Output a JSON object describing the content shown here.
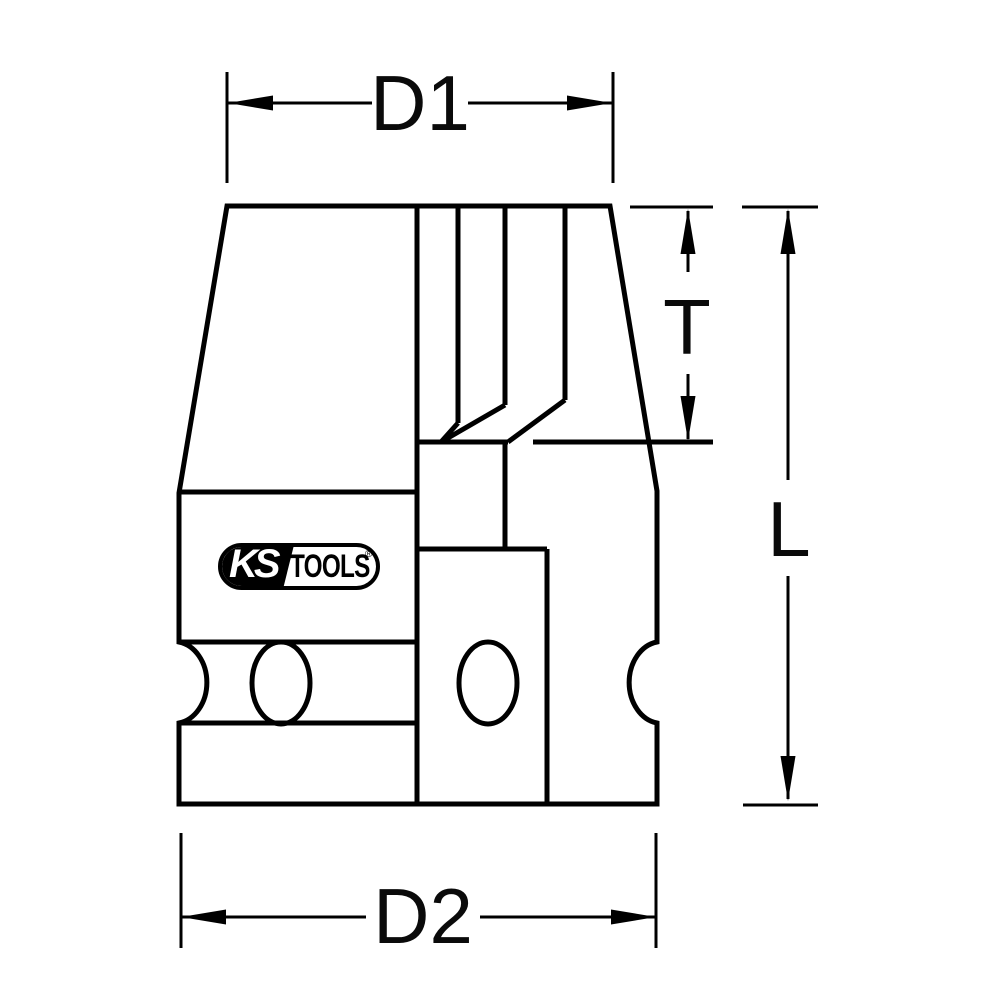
{
  "palette": {
    "ink": "#000000",
    "paper": "#ffffff"
  },
  "drawing": {
    "dimensions": {
      "d1": "D1",
      "d2": "D2",
      "t": "T",
      "l": "L"
    },
    "logo": {
      "brand": "KS",
      "suffix": "TOOLS",
      "registered": "®"
    }
  }
}
